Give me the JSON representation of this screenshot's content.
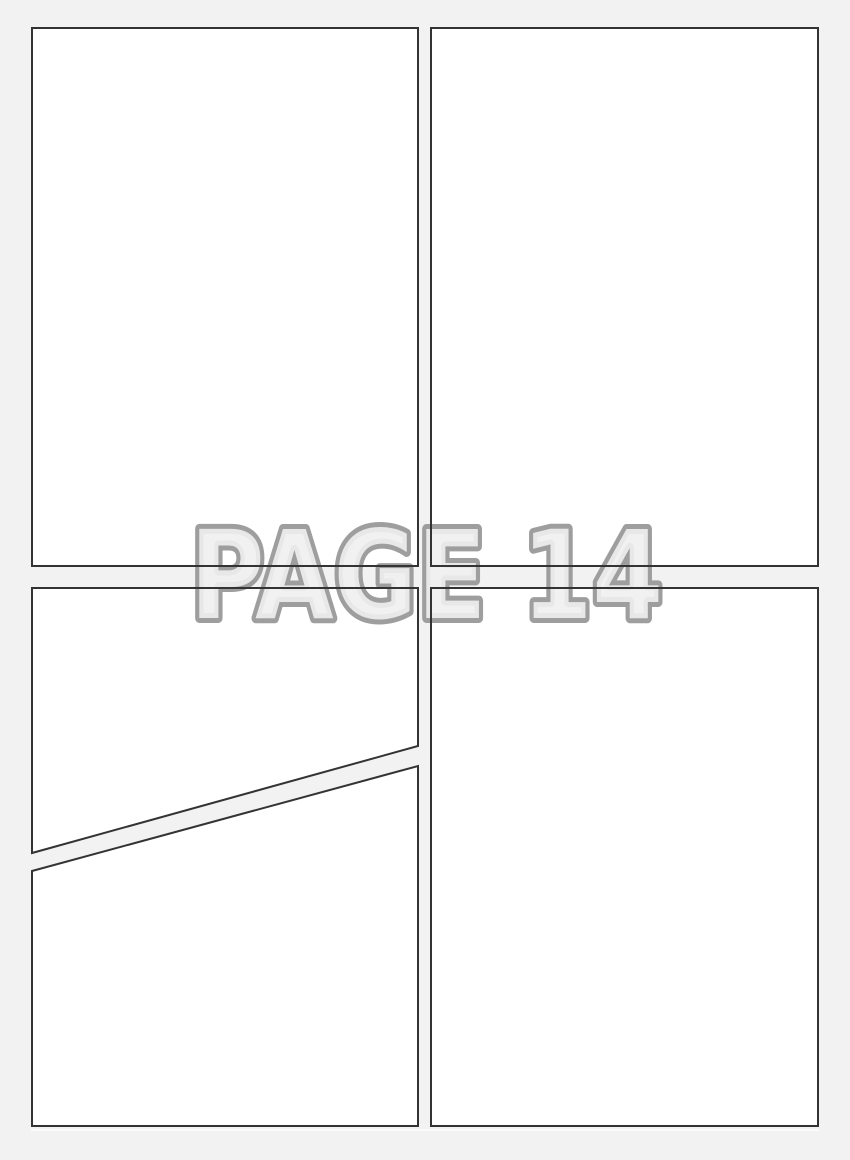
{
  "document": {
    "type": "comic-page-template",
    "watermark": {
      "label": "PAGE 14"
    },
    "panels": [
      {
        "id": "panel-top-left",
        "content": ""
      },
      {
        "id": "panel-top-right",
        "content": ""
      },
      {
        "id": "panel-bottom-left-upper",
        "content": ""
      },
      {
        "id": "panel-bottom-left-lower",
        "content": ""
      },
      {
        "id": "panel-bottom-right",
        "content": ""
      }
    ]
  },
  "colors": {
    "background": "#f2f2f2",
    "panel_fill": "#ffffff",
    "panel_border": "#333333",
    "watermark_fill": "#efefef",
    "watermark_stroke": "#9e9e9e",
    "sheet_highlight": "#ffffff"
  }
}
